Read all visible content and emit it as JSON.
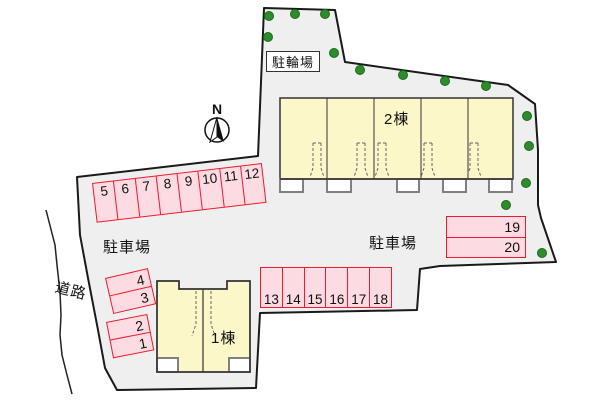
{
  "labels": {
    "bicycle_parking": "駐輪場",
    "parking_left": "駐車場",
    "parking_right": "駐車場",
    "road": "道路",
    "building1": "1棟",
    "building2": "2棟",
    "compass_north": "N"
  },
  "parking": {
    "row_top": [
      "5",
      "6",
      "7",
      "8",
      "9",
      "10",
      "11",
      "12"
    ],
    "left_upper": [
      "4",
      "3"
    ],
    "left_lower": [
      "2",
      "1"
    ],
    "row_bottom": [
      "13",
      "14",
      "15",
      "16",
      "17",
      "18"
    ],
    "right_block": [
      "19",
      "20"
    ]
  },
  "buildings": [
    {
      "name": "2棟",
      "units": 5
    },
    {
      "name": "1棟",
      "units": 2
    }
  ],
  "tree_count": 14,
  "colors": {
    "site_fill": "#efefef",
    "site_outline": "#1a1a1a",
    "parking_fill": "#fcdbe2",
    "parking_border": "#ef1a2d",
    "building_fill": "#fbf7c8",
    "building_outline": "#333333",
    "tree_green": "#2e8b2e",
    "porch_border": "#808080"
  }
}
